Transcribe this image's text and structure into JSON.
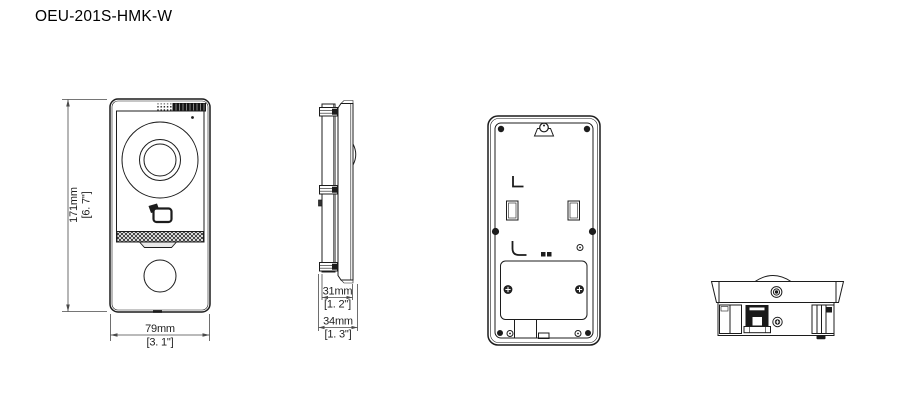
{
  "drawing": {
    "title": "OEU-201S-HMK-W",
    "colors": {
      "background": "#ffffff",
      "line": "#1c1c1c",
      "dimension_line": "#4a4a4a",
      "text": "#1f1f1f"
    },
    "views": {
      "front": {
        "height_mm": "171mm",
        "height_in": "[6. 7\"]",
        "width_mm": "79mm",
        "width_in": "[3. 1\"]"
      },
      "side": {
        "inner_depth_mm": "31mm",
        "inner_depth_in": "[1. 2\"]",
        "total_depth_mm": "34mm",
        "total_depth_in": "[1. 3\"]"
      }
    }
  }
}
